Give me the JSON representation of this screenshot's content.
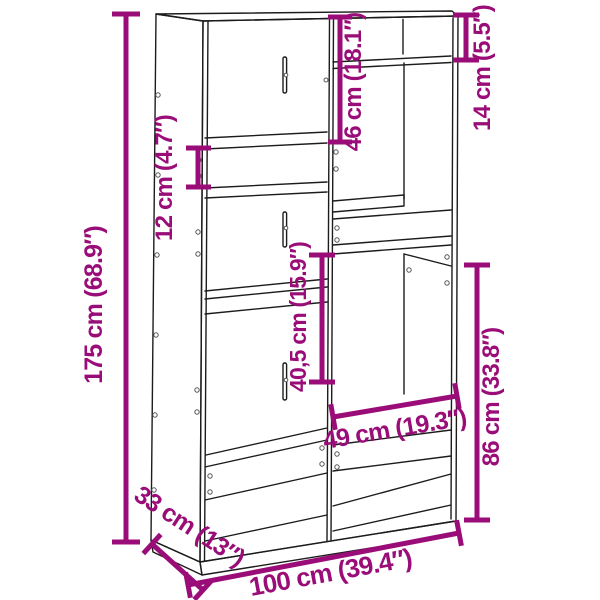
{
  "diagram": {
    "kind": "furniture-dimension-diagram",
    "subject": "staggered cube bookcase / room divider, 3D line drawing",
    "colors": {
      "accent": "#9A0D78",
      "line": "#1c1c1c",
      "background": "#ffffff"
    }
  },
  "dims": {
    "height": {
      "label": "175 cm (68.9″)"
    },
    "width": {
      "label": "100 cm (39.4″)"
    },
    "depth": {
      "label": "33 cm (13″)"
    },
    "slot": {
      "label": "12 cm (4.7″)"
    },
    "top_left": {
      "label": "46 cm (18.1″)"
    },
    "top_right": {
      "label": "14 cm (5.5″)"
    },
    "middle": {
      "label": "40,5 cm (15.9″)"
    },
    "right": {
      "label": "86 cm (33.8″)"
    },
    "inner_width": {
      "label": "49 cm (19.3″)"
    }
  }
}
